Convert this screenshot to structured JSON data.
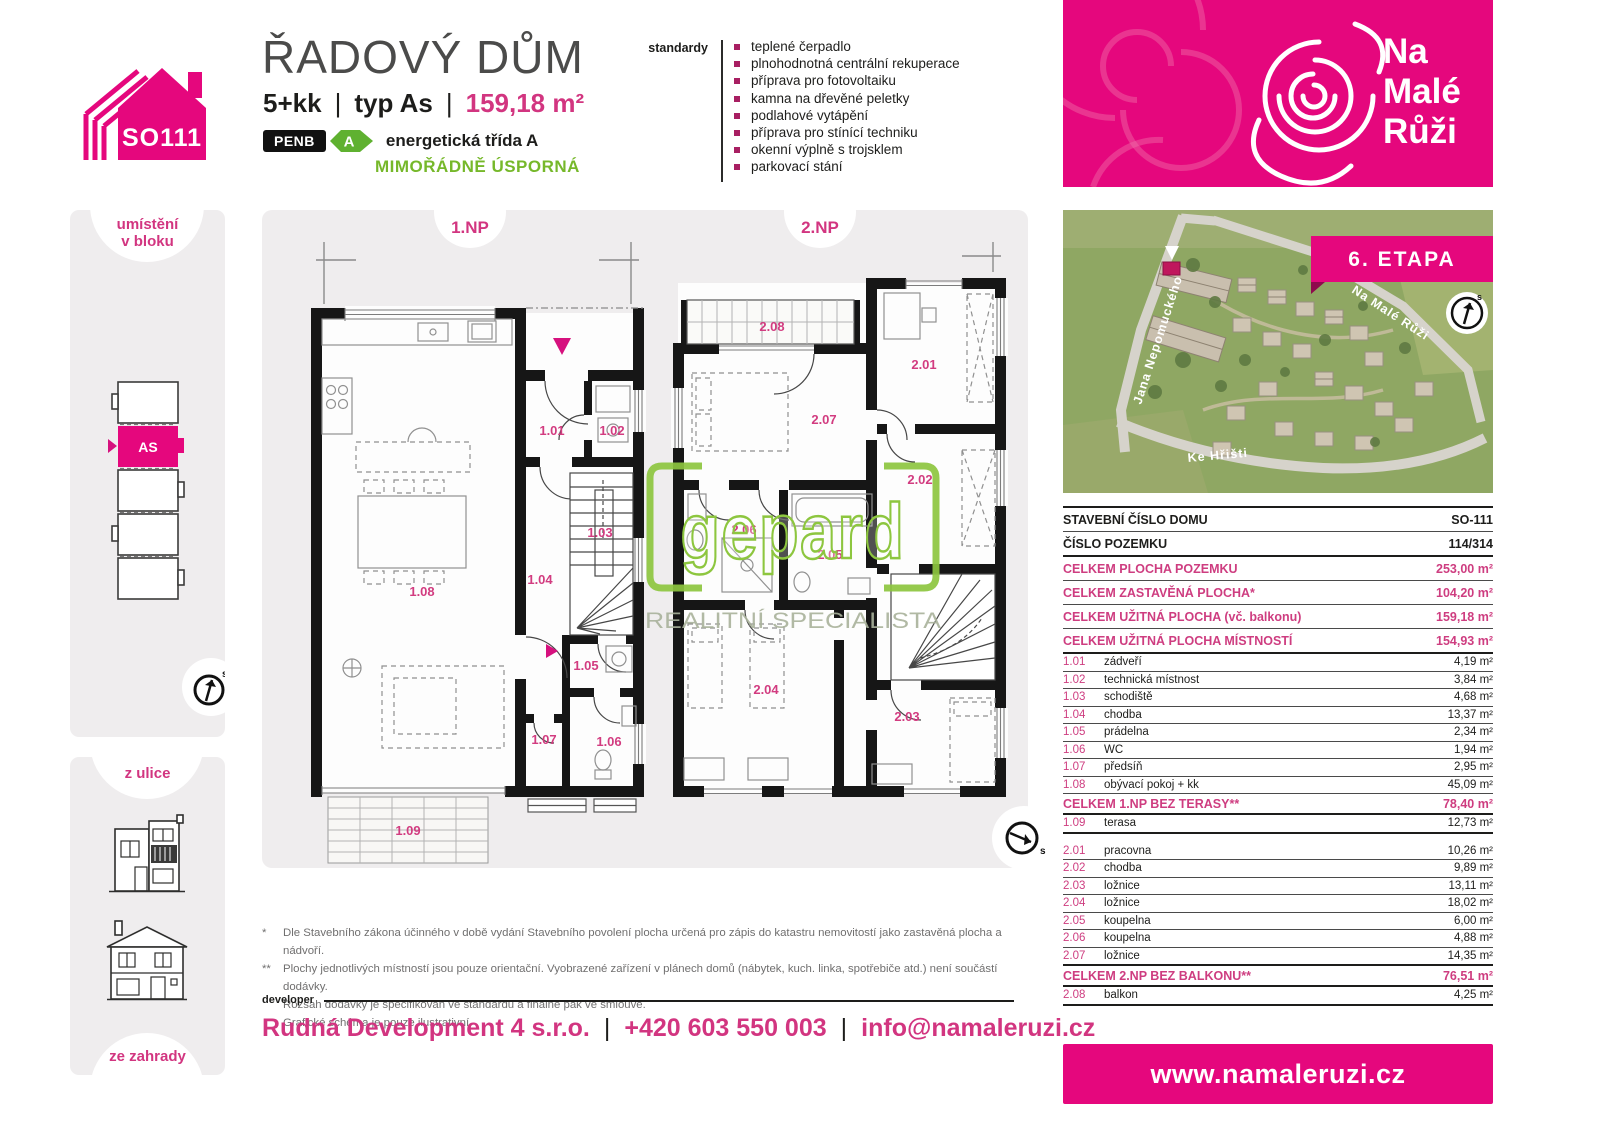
{
  "header": {
    "house_code": "SO111",
    "title": "ŘADOVÝ DŮM",
    "layout": "5+kk",
    "sep": "|",
    "type_label": "typ As",
    "area": "159,18 m²",
    "penb": "PENB",
    "energy_class": "A",
    "energy_text": "energetická třída A",
    "energy_sub": "MIMOŘÁDNĚ ÚSPORNÁ"
  },
  "standards": {
    "label": "standardy",
    "items": [
      "teplené čerpadlo",
      "plnohodnotná centrální rekuperace",
      "příprava pro fotovoltaiku",
      "kamna na dřevěné peletky",
      "podlahové vytápění",
      "příprava pro stínící techniku",
      "okenní výplně s trojsklem",
      "parkovací stání"
    ]
  },
  "logo": {
    "line1": "Na",
    "line2": "Malé",
    "line3": "Růži"
  },
  "sidebar": {
    "location_line1": "umístění",
    "location_line2": "v bloku",
    "unit": "AS",
    "street": "z ulice",
    "garden": "ze zahrady",
    "compass_letter": "s"
  },
  "plans": {
    "np1": {
      "label": "1.NP",
      "rooms": [
        "1.01",
        "1.02",
        "1.03",
        "1.04",
        "1.05",
        "1.06",
        "1.07",
        "1.08",
        "1.09"
      ]
    },
    "np2": {
      "label": "2.NP",
      "rooms": [
        "2.01",
        "2.02",
        "2.03",
        "2.04",
        "2.05",
        "2.06",
        "2.07",
        "2.08"
      ]
    },
    "watermark": {
      "name": "gepard",
      "tagline": "REALITNÍ SPECIALISTA"
    },
    "compass_letter": "s"
  },
  "aerial": {
    "stage": "6. ETAPA",
    "street1": "Jana Nepomuckého",
    "street2": "Na Malé Růži",
    "street3": "Ke Hřišti",
    "compass_letter": "s"
  },
  "table": {
    "info": [
      {
        "label": "STAVEBNÍ ČÍSLO DOMU",
        "value": "SO-111"
      },
      {
        "label": "ČÍSLO POZEMKU",
        "value": "114/314"
      }
    ],
    "summary": [
      {
        "label": "CELKEM PLOCHA POZEMKU",
        "value": "253,00 m²"
      },
      {
        "label": "CELKEM ZASTAVĚNÁ PLOCHA*",
        "value": "104,20 m²"
      },
      {
        "label": "CELKEM UŽITNÁ PLOCHA (vč. balkonu)",
        "value": "159,18 m²"
      },
      {
        "label": "CELKEM UŽITNÁ PLOCHA MÍSTNOSTÍ",
        "value": "154,93 m²"
      }
    ],
    "floor1": [
      {
        "num": "1.01",
        "name": "zádveří",
        "value": "4,19 m²"
      },
      {
        "num": "1.02",
        "name": "technická místnost",
        "value": "3,84 m²"
      },
      {
        "num": "1.03",
        "name": "schodiště",
        "value": "4,68 m²"
      },
      {
        "num": "1.04",
        "name": "chodba",
        "value": "13,37 m²"
      },
      {
        "num": "1.05",
        "name": "prádelna",
        "value": "2,34 m²"
      },
      {
        "num": "1.06",
        "name": "WC",
        "value": "1,94 m²"
      },
      {
        "num": "1.07",
        "name": "předsíň",
        "value": "2,95 m²"
      },
      {
        "num": "1.08",
        "name": "obývací pokoj + kk",
        "value": "45,09 m²"
      }
    ],
    "floor1_total": {
      "label": "CELKEM 1.NP BEZ TERASY**",
      "value": "78,40 m²"
    },
    "floor1_extra": {
      "num": "1.09",
      "name": "terasa",
      "value": "12,73 m²"
    },
    "floor2": [
      {
        "num": "2.01",
        "name": "pracovna",
        "value": "10,26 m²"
      },
      {
        "num": "2.02",
        "name": "chodba",
        "value": "9,89 m²"
      },
      {
        "num": "2.03",
        "name": "ložnice",
        "value": "13,11 m²"
      },
      {
        "num": "2.04",
        "name": "ložnice",
        "value": "18,02 m²"
      },
      {
        "num": "2.05",
        "name": "koupelna",
        "value": "6,00 m²"
      },
      {
        "num": "2.06",
        "name": "koupelna",
        "value": "4,88 m²"
      },
      {
        "num": "2.07",
        "name": "ložnice",
        "value": "14,35 m²"
      }
    ],
    "floor2_total": {
      "label": "CELKEM 2.NP BEZ BALKONU**",
      "value": "76,51 m²"
    },
    "floor2_extra": {
      "num": "2.08",
      "name": "balkon",
      "value": "4,25 m²"
    }
  },
  "footnotes": {
    "mark1": "*",
    "text1": "Dle Stavebního zákona účinného v době vydání Stavebního povolení plocha určená pro zápis do katastru nemovitostí jako zastavěná plocha a nádvoří.",
    "mark2": "**",
    "text2": "Plochy jednotlivých místností jsou pouze orientační. Vyobrazené zařízení v plánech domů (nábytek, kuch. linka, spotřebiče atd.) není součástí dodávky.",
    "text2b": "Rozsah dodávky je specifikován ve standardu a finálně pak ve smlouvě.",
    "text3": "Grafické schéma je pouze ilustrativní."
  },
  "developer": {
    "label": "developer",
    "name": "Rudná Development 4 s.r.o.",
    "sep": "|",
    "phone": "+420 603 550 003",
    "email": "info@namaleruzi.cz"
  },
  "footer": {
    "website": "www.namaleruzi.cz"
  },
  "colors": {
    "magenta": "#E5077D",
    "magenta_text": "#CE3D80",
    "green": "#5FB130",
    "green_text": "#76B82A",
    "gepard_green": "#8DC63F",
    "panel_gray": "#EFEDEE",
    "ink": "#1D1D1B"
  }
}
